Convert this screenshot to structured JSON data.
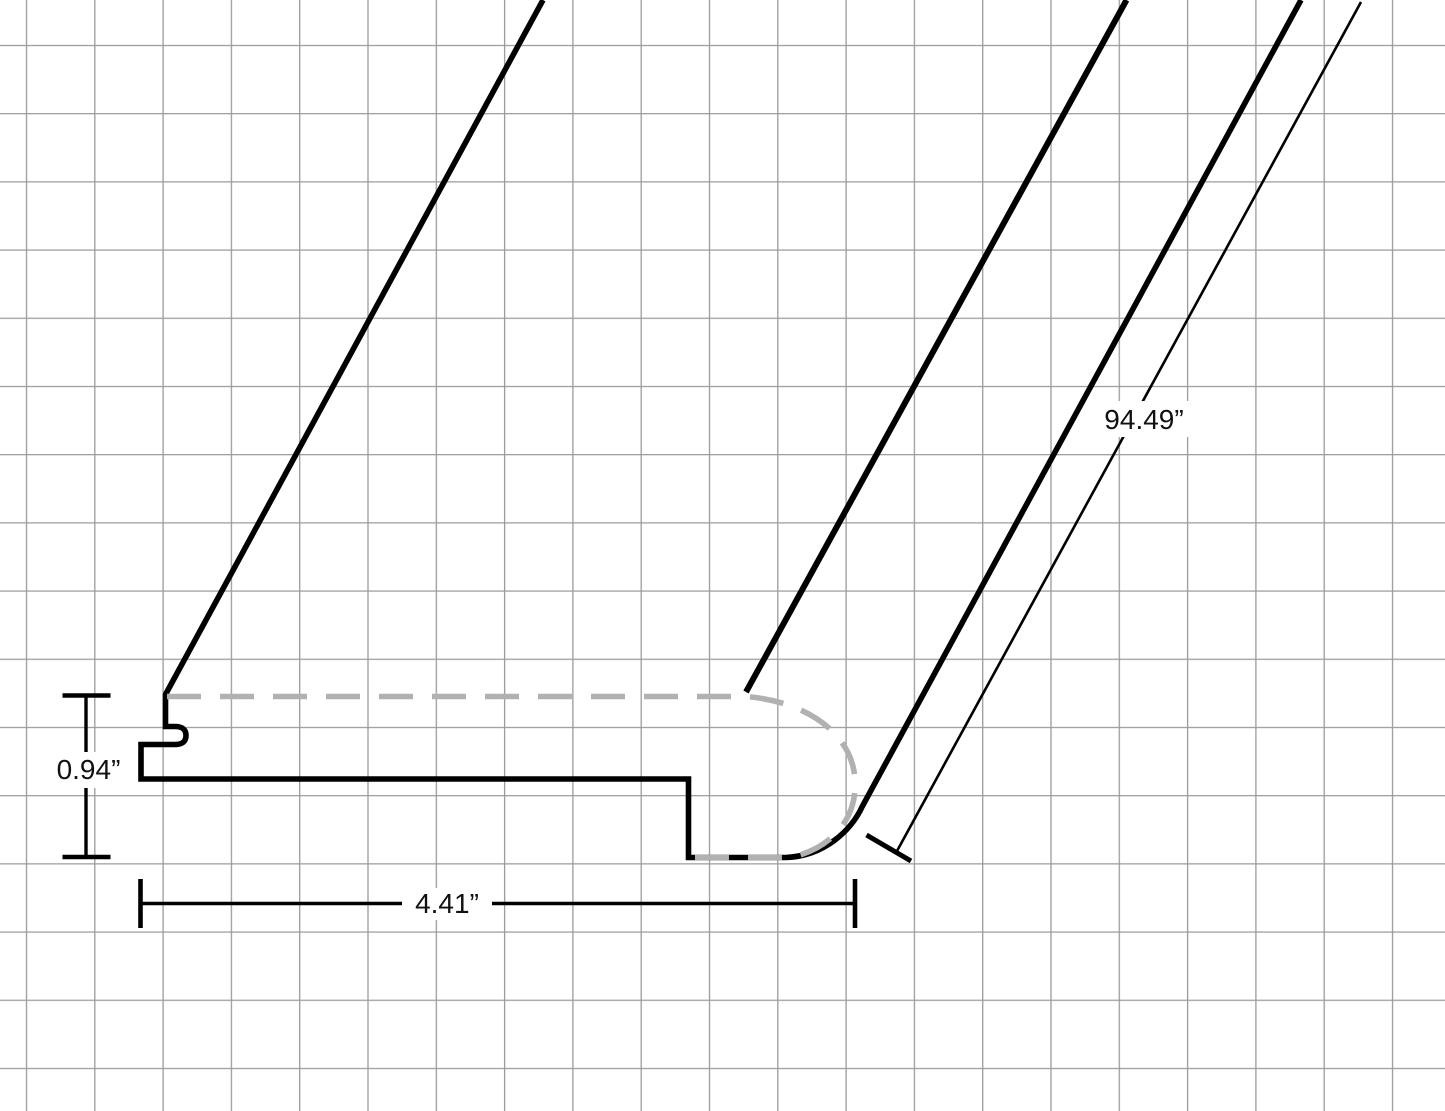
{
  "drawing": {
    "title": "Stair nose molding profile technical drawing",
    "dimensions": {
      "thickness_label": "0.94”",
      "width_label": "4.41”",
      "length_label": "94.49”"
    },
    "colors": {
      "background": "#ffffff",
      "grid_line": "#9b9b9b",
      "outline": "#000000",
      "hidden_edge": "#b1b1b1",
      "label_text": "#111111"
    }
  }
}
